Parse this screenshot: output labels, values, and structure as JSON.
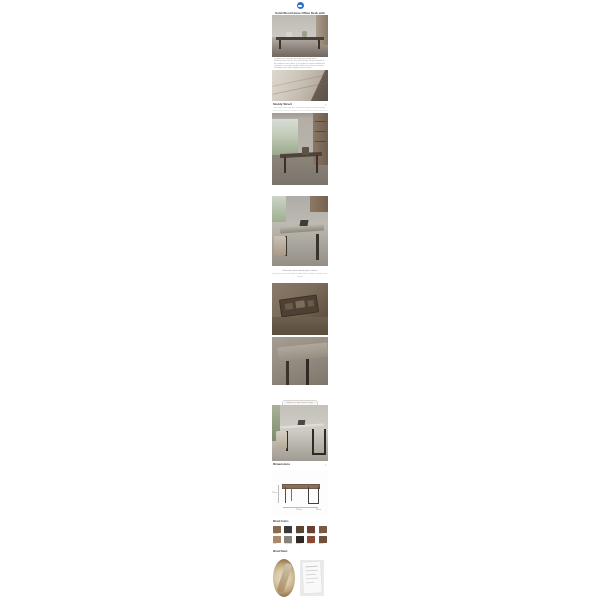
{
  "page": {
    "background": "#ffffff"
  },
  "header": {
    "logo_icon": "brand-badge",
    "logo_color": "#2f6fce",
    "title": "Solid Wood Home Office Desk with Steel Frame"
  },
  "intro": {
    "text": "Crafted from carefully selected solid wood with a thickened steel frame, this desk brings natural warmth to the modern home office. The surface is hand-sanded and sealed for a smooth, durable finish that resists scratches and daily wear while staying easy to clean."
  },
  "sturdy_section": {
    "title": "Sturdy Struct",
    "subtitle": "Thickened steel legs with solid wood top for lasting stability",
    "chevron": "›"
  },
  "tags": {
    "pill1": "Solid Wood",
    "pill2": "Steel Frame",
    "pill_color": "#c49a7e"
  },
  "caption": {
    "line1": "Selected natural wood grain surface",
    "line2": "Every corner is smoothly rounded and polished to protect your family"
  },
  "storage": {
    "capsule_label": "Hidden storage drawer design",
    "indicator": "▾"
  },
  "dimensions_section": {
    "title": "Dimensions",
    "chevron": "›",
    "height_label": "75cm",
    "width_label": "120cm",
    "depth_label": "60cm"
  },
  "swatches_section": {
    "title": "Wood Colors",
    "items": [
      {
        "label": "Walnut",
        "color": "#8a6a4f"
      },
      {
        "label": "Black Oak",
        "color": "#3a3a3a"
      },
      {
        "label": "Ebony",
        "color": "#5a4636"
      },
      {
        "label": "Rosewood",
        "color": "#6b3f33"
      },
      {
        "label": "Teak",
        "color": "#7a5a42"
      },
      {
        "label": "Oak",
        "color": "#a98a68"
      },
      {
        "label": "Grey Ash",
        "color": "#8a8178"
      },
      {
        "label": "Wenge",
        "color": "#2f2722"
      },
      {
        "label": "Cherry",
        "color": "#8a4a38"
      },
      {
        "label": "Amber",
        "color": "#6e513c"
      }
    ]
  },
  "panel_section": {
    "title": "Wood Panel"
  }
}
